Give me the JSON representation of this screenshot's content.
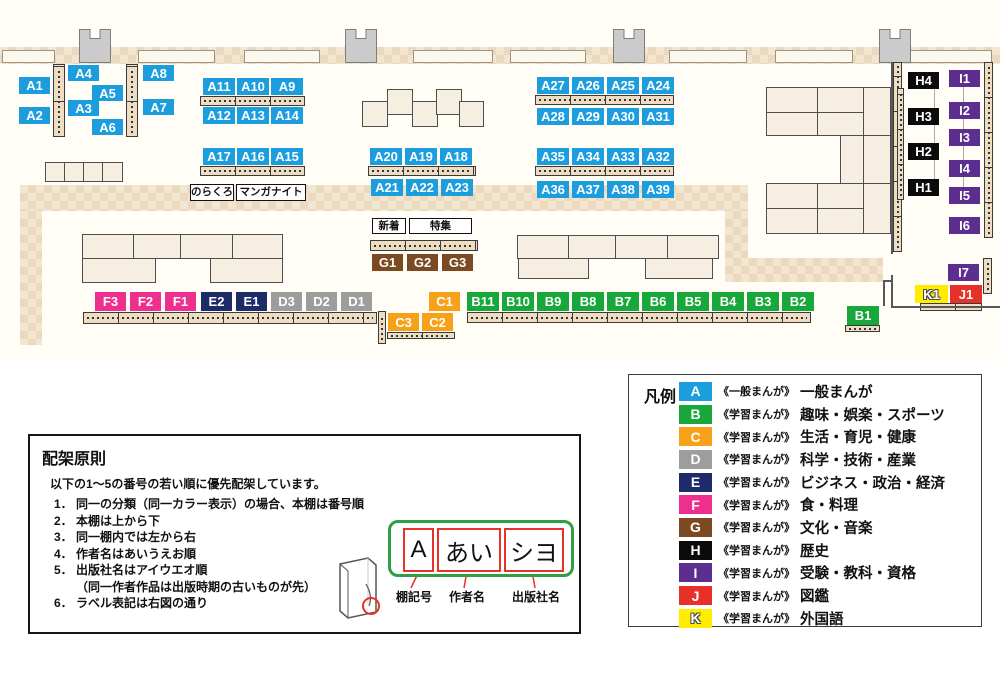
{
  "map": {
    "sections": {
      "A": {
        "color": "#1b9dde",
        "outline": false
      },
      "B": {
        "color": "#17a73a",
        "outline": false
      },
      "C": {
        "color": "#f6a118",
        "outline": false
      },
      "D": {
        "color": "#9d9d9e",
        "outline": false
      },
      "E": {
        "color": "#1d2c69",
        "outline": false
      },
      "F": {
        "color": "#ef2f8d",
        "outline": false
      },
      "G": {
        "color": "#7b4a22",
        "outline": false
      },
      "H": {
        "color": "#0b0b0b",
        "outline": false
      },
      "I": {
        "color": "#5c2e90",
        "outline": false
      },
      "J": {
        "color": "#e63028",
        "outline": false
      },
      "K": {
        "color": "#ffec00",
        "outline": true
      }
    },
    "shelf_labels": [
      {
        "id": "A1",
        "x": 19,
        "y": 77,
        "w": 31,
        "h": 17
      },
      {
        "id": "A2",
        "x": 19,
        "y": 107,
        "w": 31,
        "h": 17
      },
      {
        "id": "A4",
        "x": 68,
        "y": 65,
        "w": 31,
        "h": 16
      },
      {
        "id": "A5",
        "x": 92,
        "y": 85,
        "w": 31,
        "h": 16
      },
      {
        "id": "A3",
        "x": 68,
        "y": 100,
        "w": 31,
        "h": 16
      },
      {
        "id": "A6",
        "x": 92,
        "y": 119,
        "w": 31,
        "h": 16
      },
      {
        "id": "A8",
        "x": 143,
        "y": 65,
        "w": 31,
        "h": 16
      },
      {
        "id": "A7",
        "x": 143,
        "y": 99,
        "w": 31,
        "h": 16
      },
      {
        "id": "A11",
        "x": 203,
        "y": 78,
        "w": 32,
        "h": 17
      },
      {
        "id": "A10",
        "x": 237,
        "y": 78,
        "w": 32,
        "h": 17
      },
      {
        "id": "A9",
        "x": 271,
        "y": 78,
        "w": 32,
        "h": 17
      },
      {
        "id": "A12",
        "x": 203,
        "y": 107,
        "w": 32,
        "h": 17
      },
      {
        "id": "A13",
        "x": 237,
        "y": 107,
        "w": 32,
        "h": 17
      },
      {
        "id": "A14",
        "x": 271,
        "y": 107,
        "w": 32,
        "h": 17
      },
      {
        "id": "A17",
        "x": 203,
        "y": 148,
        "w": 32,
        "h": 17
      },
      {
        "id": "A16",
        "x": 237,
        "y": 148,
        "w": 32,
        "h": 17
      },
      {
        "id": "A15",
        "x": 271,
        "y": 148,
        "w": 32,
        "h": 17
      },
      {
        "id": "A20",
        "x": 370,
        "y": 148,
        "w": 32,
        "h": 17
      },
      {
        "id": "A19",
        "x": 405,
        "y": 148,
        "w": 32,
        "h": 17
      },
      {
        "id": "A18",
        "x": 440,
        "y": 148,
        "w": 32,
        "h": 17
      },
      {
        "id": "A21",
        "x": 371,
        "y": 179,
        "w": 32,
        "h": 17
      },
      {
        "id": "A22",
        "x": 406,
        "y": 179,
        "w": 32,
        "h": 17
      },
      {
        "id": "A23",
        "x": 441,
        "y": 179,
        "w": 32,
        "h": 17
      },
      {
        "id": "A27",
        "x": 537,
        "y": 77,
        "w": 32,
        "h": 17
      },
      {
        "id": "A26",
        "x": 572,
        "y": 77,
        "w": 32,
        "h": 17
      },
      {
        "id": "A25",
        "x": 607,
        "y": 77,
        "w": 32,
        "h": 17
      },
      {
        "id": "A24",
        "x": 642,
        "y": 77,
        "w": 32,
        "h": 17
      },
      {
        "id": "A28",
        "x": 537,
        "y": 108,
        "w": 32,
        "h": 17
      },
      {
        "id": "A29",
        "x": 572,
        "y": 108,
        "w": 32,
        "h": 17
      },
      {
        "id": "A30",
        "x": 607,
        "y": 108,
        "w": 32,
        "h": 17
      },
      {
        "id": "A31",
        "x": 642,
        "y": 108,
        "w": 32,
        "h": 17
      },
      {
        "id": "A35",
        "x": 537,
        "y": 148,
        "w": 32,
        "h": 17
      },
      {
        "id": "A34",
        "x": 572,
        "y": 148,
        "w": 32,
        "h": 17
      },
      {
        "id": "A33",
        "x": 607,
        "y": 148,
        "w": 32,
        "h": 17
      },
      {
        "id": "A32",
        "x": 642,
        "y": 148,
        "w": 32,
        "h": 17
      },
      {
        "id": "A36",
        "x": 537,
        "y": 181,
        "w": 32,
        "h": 17
      },
      {
        "id": "A37",
        "x": 572,
        "y": 181,
        "w": 32,
        "h": 17
      },
      {
        "id": "A38",
        "x": 607,
        "y": 181,
        "w": 32,
        "h": 17
      },
      {
        "id": "A39",
        "x": 642,
        "y": 181,
        "w": 32,
        "h": 17
      },
      {
        "id": "G1",
        "x": 372,
        "y": 254,
        "w": 31,
        "h": 17
      },
      {
        "id": "G2",
        "x": 407,
        "y": 254,
        "w": 31,
        "h": 17
      },
      {
        "id": "G3",
        "x": 442,
        "y": 254,
        "w": 31,
        "h": 17
      },
      {
        "id": "F3",
        "x": 95,
        "y": 292,
        "w": 31,
        "h": 19
      },
      {
        "id": "F2",
        "x": 130,
        "y": 292,
        "w": 31,
        "h": 19
      },
      {
        "id": "F1",
        "x": 165,
        "y": 292,
        "w": 31,
        "h": 19
      },
      {
        "id": "E2",
        "x": 201,
        "y": 292,
        "w": 31,
        "h": 19
      },
      {
        "id": "E1",
        "x": 236,
        "y": 292,
        "w": 31,
        "h": 19
      },
      {
        "id": "D3",
        "x": 271,
        "y": 292,
        "w": 31,
        "h": 19
      },
      {
        "id": "D2",
        "x": 306,
        "y": 292,
        "w": 31,
        "h": 19
      },
      {
        "id": "D1",
        "x": 341,
        "y": 292,
        "w": 31,
        "h": 19
      },
      {
        "id": "C1",
        "x": 429,
        "y": 292,
        "w": 31,
        "h": 19
      },
      {
        "id": "C3",
        "x": 388,
        "y": 313,
        "w": 31,
        "h": 18
      },
      {
        "id": "C2",
        "x": 422,
        "y": 313,
        "w": 31,
        "h": 18
      },
      {
        "id": "B11",
        "x": 467,
        "y": 292,
        "w": 32,
        "h": 19
      },
      {
        "id": "B10",
        "x": 502,
        "y": 292,
        "w": 32,
        "h": 19
      },
      {
        "id": "B9",
        "x": 537,
        "y": 292,
        "w": 32,
        "h": 19
      },
      {
        "id": "B8",
        "x": 572,
        "y": 292,
        "w": 32,
        "h": 19
      },
      {
        "id": "B7",
        "x": 607,
        "y": 292,
        "w": 32,
        "h": 19
      },
      {
        "id": "B6",
        "x": 642,
        "y": 292,
        "w": 32,
        "h": 19
      },
      {
        "id": "B5",
        "x": 677,
        "y": 292,
        "w": 32,
        "h": 19
      },
      {
        "id": "B4",
        "x": 712,
        "y": 292,
        "w": 32,
        "h": 19
      },
      {
        "id": "B3",
        "x": 747,
        "y": 292,
        "w": 32,
        "h": 19
      },
      {
        "id": "B2",
        "x": 782,
        "y": 292,
        "w": 32,
        "h": 19
      },
      {
        "id": "B1",
        "x": 847,
        "y": 306,
        "w": 32,
        "h": 19
      },
      {
        "id": "H4",
        "x": 908,
        "y": 72,
        "w": 31,
        "h": 17
      },
      {
        "id": "H3",
        "x": 908,
        "y": 108,
        "w": 31,
        "h": 17
      },
      {
        "id": "H2",
        "x": 908,
        "y": 143,
        "w": 31,
        "h": 17
      },
      {
        "id": "H1",
        "x": 908,
        "y": 179,
        "w": 31,
        "h": 17
      },
      {
        "id": "I1",
        "x": 949,
        "y": 70,
        "w": 31,
        "h": 17
      },
      {
        "id": "I2",
        "x": 949,
        "y": 102,
        "w": 31,
        "h": 17
      },
      {
        "id": "I3",
        "x": 949,
        "y": 129,
        "w": 31,
        "h": 17
      },
      {
        "id": "I4",
        "x": 949,
        "y": 160,
        "w": 31,
        "h": 17
      },
      {
        "id": "I5",
        "x": 949,
        "y": 187,
        "w": 31,
        "h": 17
      },
      {
        "id": "I6",
        "x": 949,
        "y": 217,
        "w": 31,
        "h": 17
      },
      {
        "id": "I7",
        "x": 948,
        "y": 264,
        "w": 31,
        "h": 17
      },
      {
        "id": "K1",
        "x": 915,
        "y": 285,
        "w": 33,
        "h": 18
      },
      {
        "id": "J1",
        "x": 950,
        "y": 285,
        "w": 32,
        "h": 18
      }
    ],
    "annotations": [
      {
        "text": "のらくろ",
        "x": 190,
        "y": 184,
        "w": 44,
        "h": 17
      },
      {
        "text": "マンガナイト",
        "x": 236,
        "y": 184,
        "w": 70,
        "h": 17
      },
      {
        "text": "新着",
        "x": 372,
        "y": 218,
        "w": 34,
        "h": 16
      },
      {
        "text": "特集",
        "x": 409,
        "y": 218,
        "w": 63,
        "h": 16
      }
    ]
  },
  "legend": {
    "title": "凡例",
    "items": [
      {
        "code": "A",
        "color": "#1b9dde",
        "outline": false,
        "prefix": "《一般まんが》",
        "label": "一般まんが"
      },
      {
        "code": "B",
        "color": "#17a73a",
        "outline": false,
        "prefix": "《学習まんが》",
        "label": "趣味・娯楽・スポーツ"
      },
      {
        "code": "C",
        "color": "#f6a118",
        "outline": false,
        "prefix": "《学習まんが》",
        "label": "生活・育児・健康"
      },
      {
        "code": "D",
        "color": "#9d9d9e",
        "outline": false,
        "prefix": "《学習まんが》",
        "label": "科学・技術・産業"
      },
      {
        "code": "E",
        "color": "#1d2c69",
        "outline": false,
        "prefix": "《学習まんが》",
        "label": "ビジネス・政治・経済"
      },
      {
        "code": "F",
        "color": "#ef2f8d",
        "outline": false,
        "prefix": "《学習まんが》",
        "label": "食・料理"
      },
      {
        "code": "G",
        "color": "#7b4a22",
        "outline": false,
        "prefix": "《学習まんが》",
        "label": "文化・音楽"
      },
      {
        "code": "H",
        "color": "#0b0b0b",
        "outline": false,
        "prefix": "《学習まんが》",
        "label": "歴史"
      },
      {
        "code": "I",
        "color": "#5c2e90",
        "outline": false,
        "prefix": "《学習まんが》",
        "label": "受験・教科・資格"
      },
      {
        "code": "J",
        "color": "#e63028",
        "outline": false,
        "prefix": "《学習まんが》",
        "label": "図鑑"
      },
      {
        "code": "K",
        "color": "#ffec00",
        "outline": true,
        "prefix": "《学習まんが》",
        "label": "外国語"
      }
    ]
  },
  "principles": {
    "title": "配架原則",
    "intro": "以下の1～5の番号の若い順に優先配架しています。",
    "items": [
      {
        "num": "1．",
        "text": "同一の分類（同一カラー表示）の場合、本棚は番号順"
      },
      {
        "num": "2．",
        "text": "本棚は上から下"
      },
      {
        "num": "3．",
        "text": "同一棚内では左から右"
      },
      {
        "num": "4．",
        "text": "作者名はあいうえお順"
      },
      {
        "num": "5．",
        "text": "出版社名はアイウエオ順",
        "sub": "（同一作者作品は出版時期の古いものが先）"
      },
      {
        "num": "6．",
        "text": "ラベル表記は右図の通り"
      }
    ],
    "label_example": {
      "shelf_code": "A",
      "author": "あい",
      "publisher": "シヨ"
    },
    "pointers": [
      "棚記号",
      "作者名",
      "出版社名"
    ]
  }
}
